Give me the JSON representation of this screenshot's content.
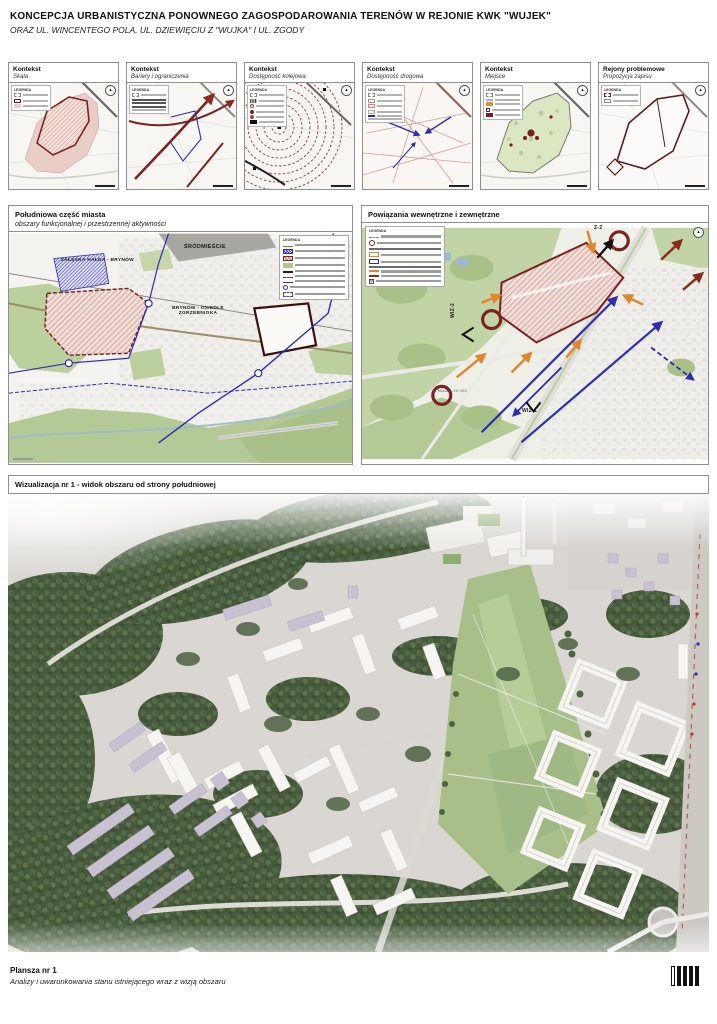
{
  "header": {
    "title": "KONCEPCJA URBANISTYCZNA PONOWNEGO ZAGOSPODAROWANIA TERENÓW W REJONIE KWK \"WUJEK\"",
    "subtitle": "ORAZ UL. WINCENTEGO POLA, UL. DZIEWIĘCIU Z \"WUJKA\" I UL. ZGODY"
  },
  "legend_title": "LEGENDA",
  "context_cards": [
    {
      "title": "Kontekst",
      "subtitle": "Skala"
    },
    {
      "title": "Kontekst",
      "subtitle": "Bariery i ograniczenia"
    },
    {
      "title": "Kontekst",
      "subtitle": "Dostępność kolejowa"
    },
    {
      "title": "Kontekst",
      "subtitle": "Dostępność drogowa"
    },
    {
      "title": "Kontekst",
      "subtitle": "Miejsce"
    },
    {
      "title": "Rejony problemowe",
      "subtitle": "Propozycja zapisu"
    }
  ],
  "south_map": {
    "title": "Południowa część miasta",
    "subtitle": "obszary funkcjonalnej i przestrzennej aktywności",
    "label_srodmiescie": "ŚRÓDMIEŚCIE",
    "label_zaleska": "ZAŁĘSKA HAŁDA - BRYNÓW",
    "label_brynow_1": "BRYNÓW - OSIEDLE",
    "label_brynow_2": "ZGRZEBNIOKA"
  },
  "connections_map": {
    "title": "Powiązania wewnętrzne i zewnętrzne",
    "label_z2": "Z-2",
    "label_wiz1": "WIZ-1",
    "label_wiz2": "WIZ-2",
    "scale": "skala 1:20 000"
  },
  "visualization": {
    "title": "Wizualizacja nr 1 - widok obszaru od strony południowej"
  },
  "footer": {
    "title": "Plansza nr 1",
    "subtitle": "Analizy i uwarunkowania stanu istniejącego wraz z wizją obszaru"
  },
  "colors": {
    "accent_dark_red": "#7a2323",
    "pink_fill": "#e9cec8",
    "green_fill": "#bcd09d",
    "blue": "#2d2db4",
    "orange": "#e0862e"
  }
}
